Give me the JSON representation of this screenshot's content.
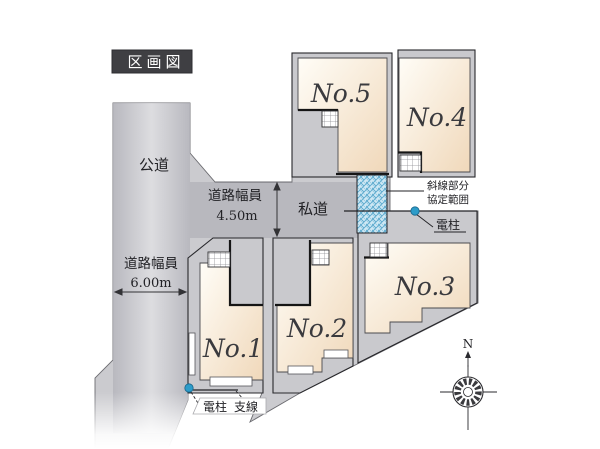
{
  "title": "区画図",
  "roads": {
    "public": {
      "label": "公道"
    },
    "private": {
      "label": "私道"
    },
    "private_width": {
      "label": "道路幅員",
      "value": "4.50m"
    },
    "public_width": {
      "label": "道路幅員",
      "value": "6.00m"
    }
  },
  "lots": [
    {
      "id": 1,
      "label": "No.1"
    },
    {
      "id": 2,
      "label": "No.2"
    },
    {
      "id": 3,
      "label": "No.3"
    },
    {
      "id": 4,
      "label": "No.4"
    },
    {
      "id": 5,
      "label": "No.5"
    }
  ],
  "annotations": {
    "agreement_area": {
      "line1": "斜線部分",
      "line2": "協定範囲"
    },
    "utility_pole_right": "電柱",
    "utility_pole_bottom": "電柱",
    "guy_wire": "支線",
    "compass_north": "N"
  },
  "colors": {
    "road_gray": "#cbcbcf",
    "road_band_light": "#dedee1",
    "private_road_gray": "#b9b9c0",
    "lot_gray": "#c9c9cd",
    "building_cream_light": "#fffdf7",
    "building_cream": "#f3ddc0",
    "hatch_blue_bg": "#cfe8f4",
    "hatch_blue_line": "#58a7cc",
    "pole_blue": "#2d9cc9",
    "title_bg": "#3f3f43",
    "title_text": "#ffffff",
    "line_dark": "#222222"
  }
}
